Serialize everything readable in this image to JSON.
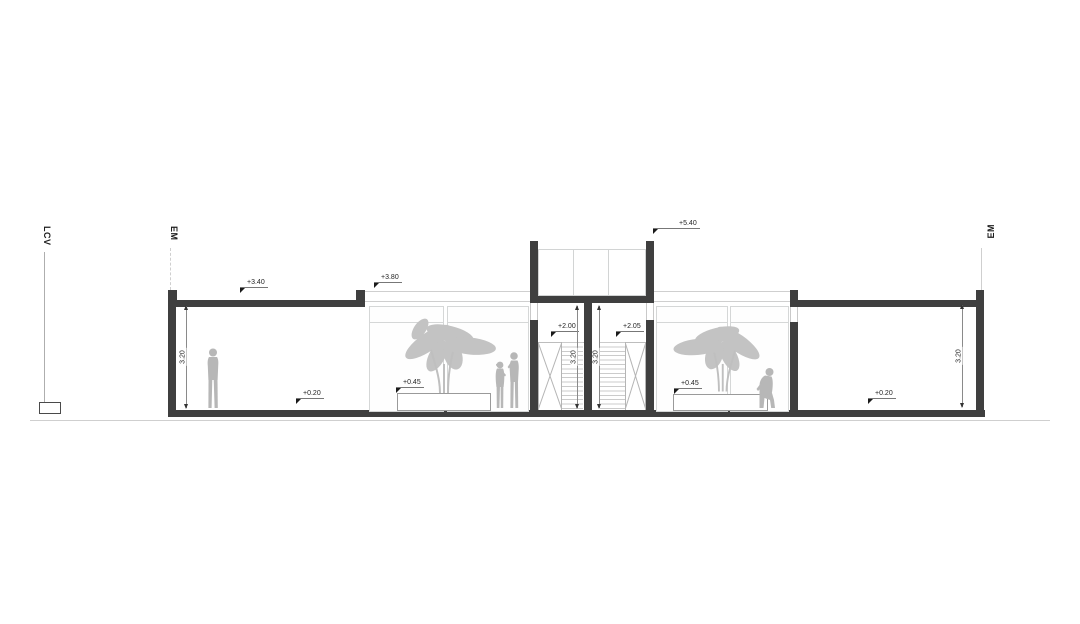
{
  "drawing_title": "building cross section",
  "colors": {
    "wall": "#3f3f3f",
    "figure": "#b7b7b7",
    "foliage": "#c3c3c3",
    "glass_frame": "#d5d7d7",
    "ground_line": "#c9c9c9",
    "annotation_text": "#1f1f1f"
  },
  "site_labels": {
    "lcv": "LCV",
    "em_left": "EM",
    "em_right": "EM"
  },
  "level_markers": {
    "roof_left": "+3.40",
    "atrium_roof": "+3.80",
    "bulkhead_top": "+5.40",
    "stair_landing_left": "+2.00",
    "stair_landing_right": "+2.05",
    "planter_left": "+0.45",
    "planter_right": "+0.45",
    "floor_left": "+0.20",
    "floor_right": "+0.20"
  },
  "dimensions": {
    "room_left_height": "3.20",
    "stair_left_height": "3.20",
    "stair_right_height": "3.20",
    "room_right_height": "3.20"
  }
}
